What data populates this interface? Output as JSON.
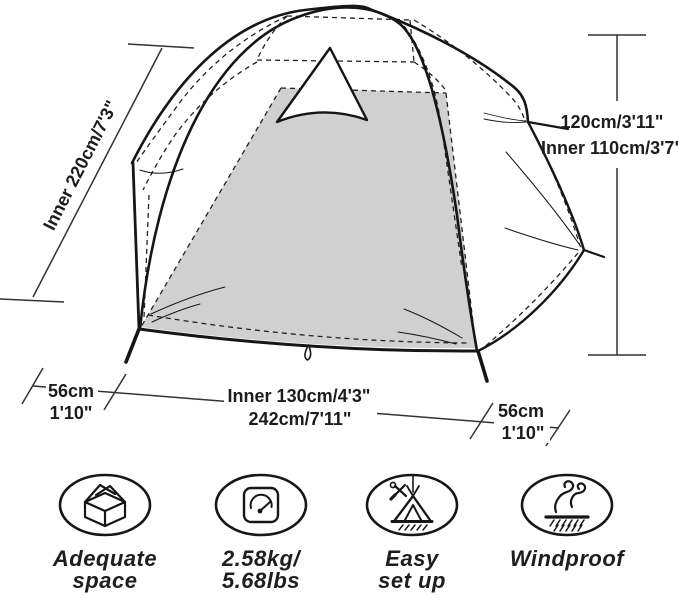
{
  "dimensions": {
    "inner_length": "Inner 220cm/7'3\"",
    "outer_height": "120cm/3'11\"",
    "inner_height": "Inner 110cm/3'7\"",
    "left_vestibule_cm": "56cm",
    "left_vestibule_ft": "1'10\"",
    "inner_width": "Inner 130cm/4'3\"",
    "total_width": "242cm/7'11\"",
    "right_vestibule_cm": "56cm",
    "right_vestibule_ft": "1'10\""
  },
  "features": [
    {
      "icon": "open-box-icon",
      "label_line1": "Adequate",
      "label_line2": "space"
    },
    {
      "icon": "scale-icon",
      "label_line1": "2.58kg/",
      "label_line2": "5.68lbs"
    },
    {
      "icon": "tent-setup-icon",
      "label_line1": "Easy",
      "label_line2": "set up"
    },
    {
      "icon": "wind-icon",
      "label_line1": "Windproof",
      "label_line2": ""
    }
  ],
  "colors": {
    "floor_gray": "#d0d0d0",
    "line": "#161616",
    "dimension_text": "#1c1c1c"
  }
}
